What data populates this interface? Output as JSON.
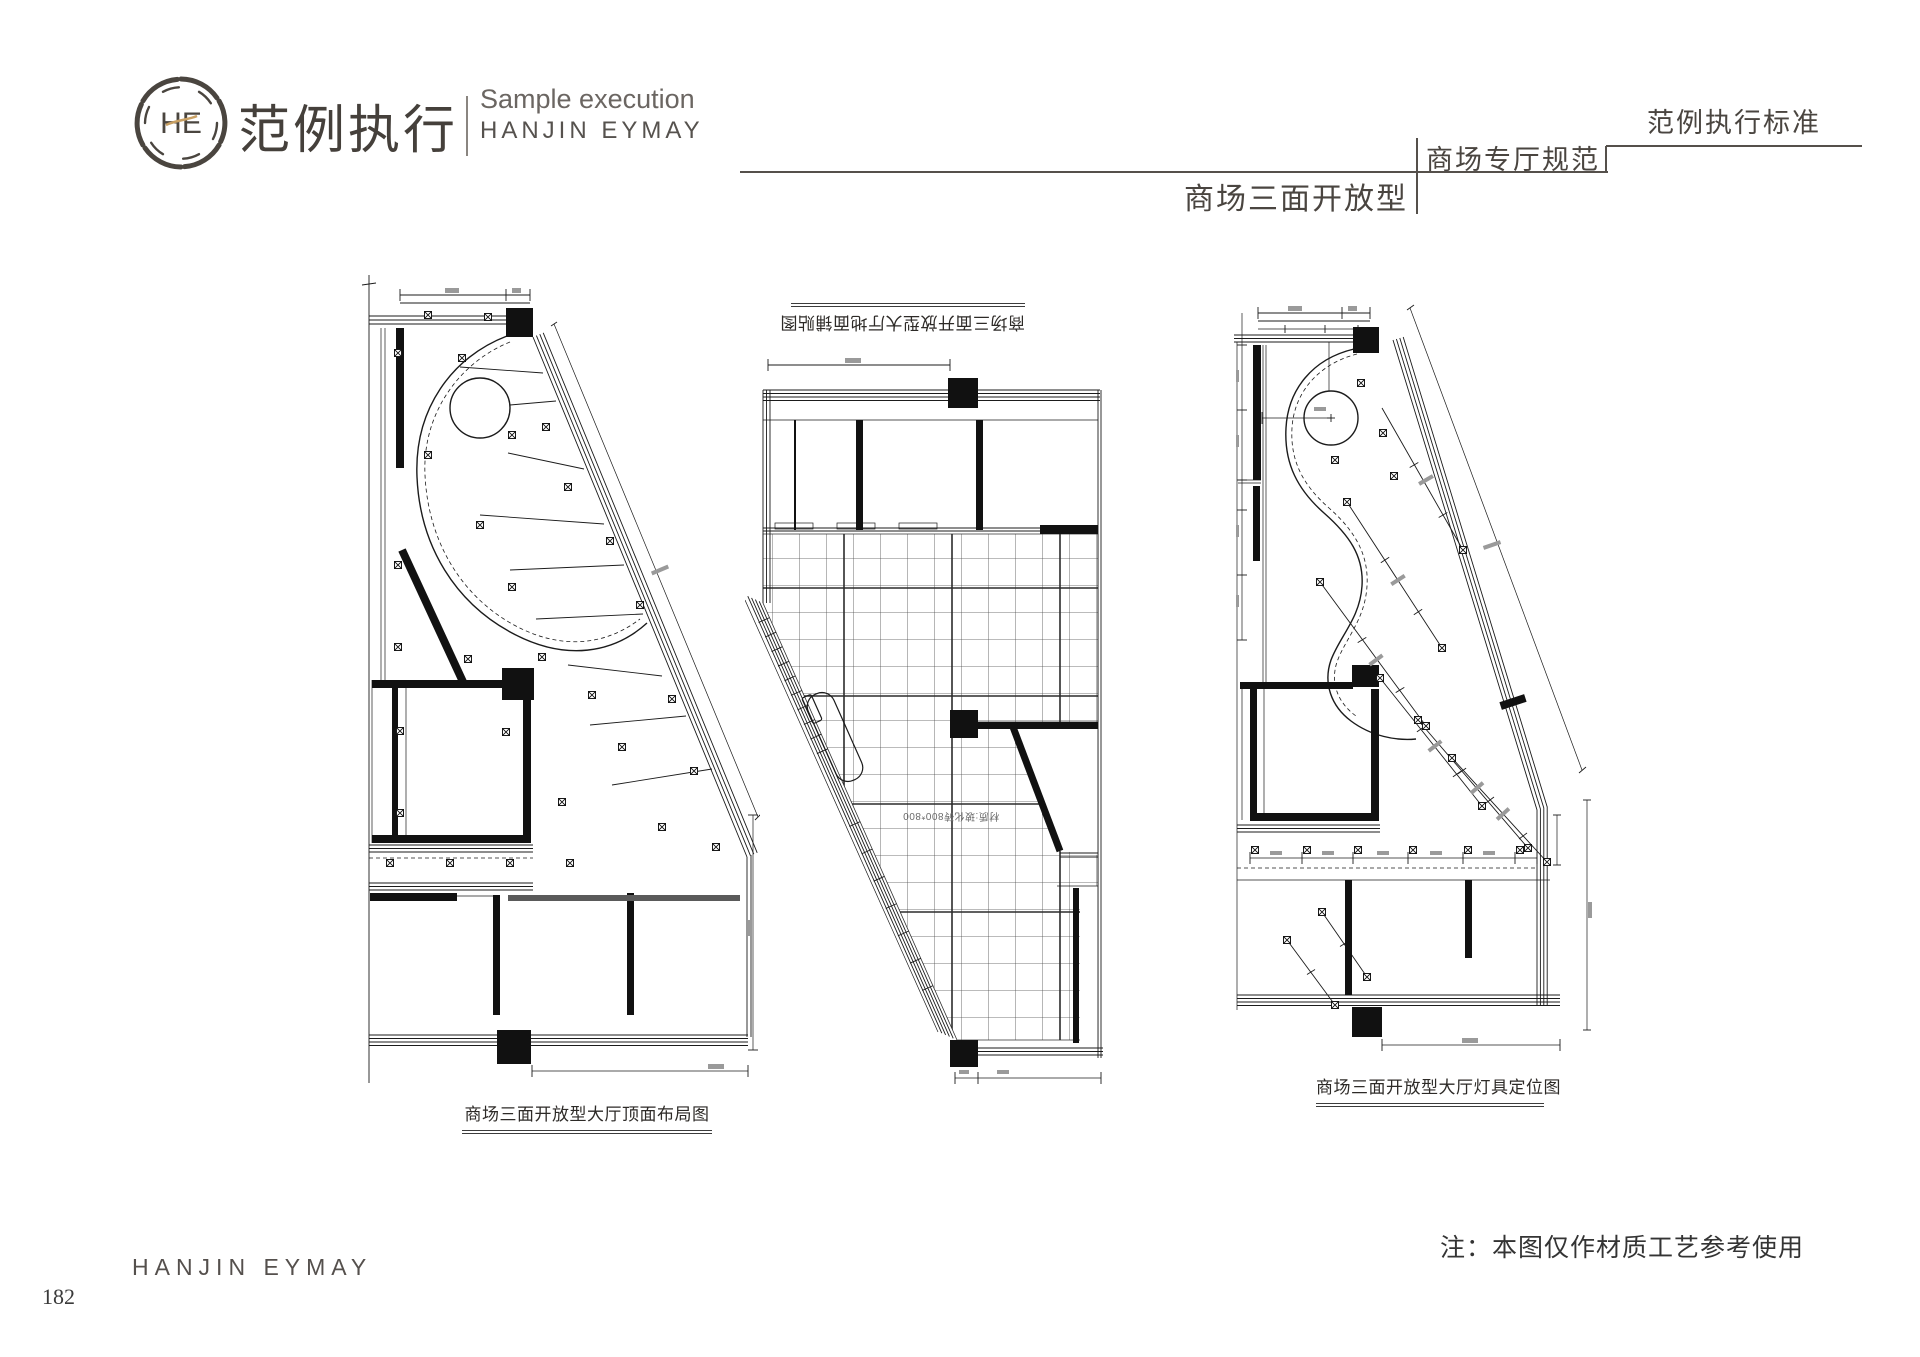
{
  "header": {
    "logo_monogram": "HE",
    "brand_cn": "范例执行",
    "tagline_en": "Sample execution",
    "brand_en": "HANJIN EYMAY",
    "standard_label": "范例执行标准",
    "section_label": "商场专厅规范",
    "page_title": "商场三面开放型"
  },
  "drawings": {
    "ceiling": {
      "caption": "商场三面开放型大厅顶面布局图"
    },
    "floor": {
      "caption": "商场三面开放型大厅地面铺贴图",
      "material_note": "材质:玻化砖800*800"
    },
    "lighting": {
      "caption": "商场三面开放型大厅灯具定位图"
    }
  },
  "footer": {
    "brand": "HANJIN EYMAY",
    "page_number": "182",
    "note": "注：本图仅作材质工艺参考使用"
  },
  "colors": {
    "ink": "#3f3b37",
    "gold": "#c9a063"
  }
}
